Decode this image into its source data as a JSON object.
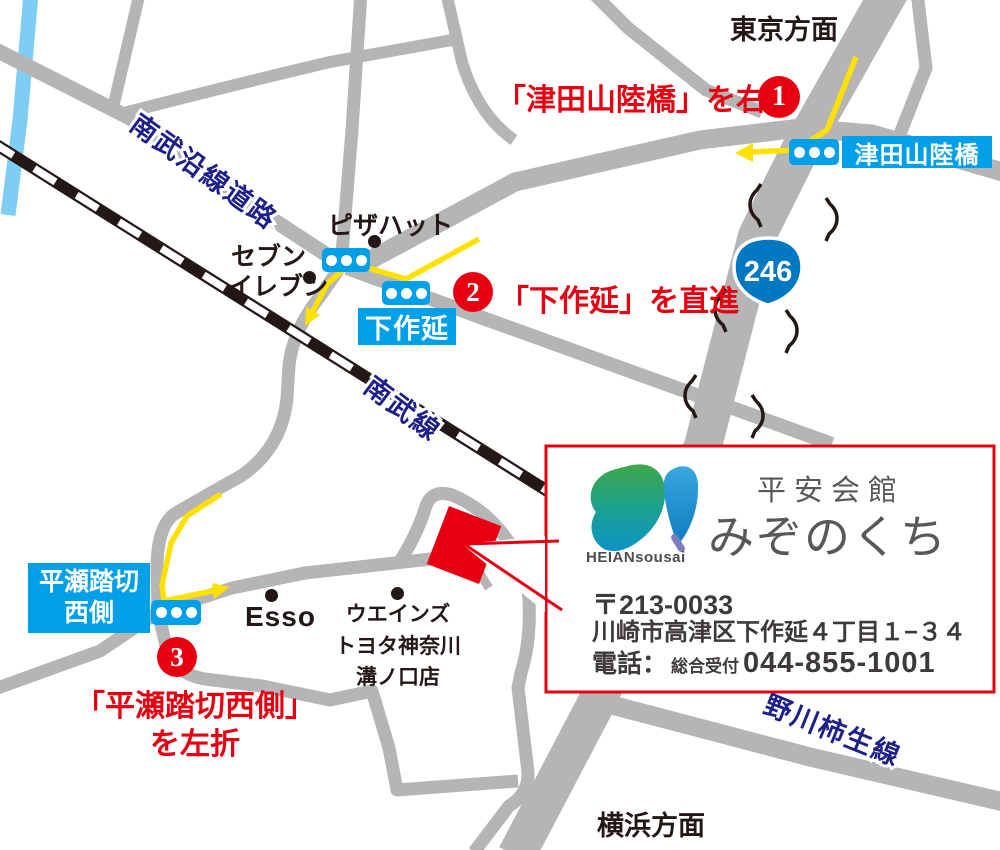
{
  "directions": {
    "tokyo": "東京方面",
    "yokohama": "横浜方面"
  },
  "roads": {
    "nanbu_ensen": "南武沿線道路",
    "nanbu_line": "南武線",
    "nogawa_kakio": "野川柿生線",
    "route_shield": "246"
  },
  "signals": {
    "tsudayama": "津田山陸橋",
    "shimosakunobe": "下作延",
    "hirase_line1": "平瀬踏切",
    "hirase_line2": "西側"
  },
  "steps": {
    "one": {
      "num": "1",
      "text": "「津田山陸橋」を右折"
    },
    "two": {
      "num": "2",
      "text": "「下作延」を直進"
    },
    "three": {
      "num": "3",
      "line1": "「平瀬踏切西側」",
      "line2": "を左折"
    }
  },
  "pois": {
    "pizza_hut": "ピザハット",
    "seven1": "セブン",
    "seven2": "イレブン",
    "esso": "Esso",
    "weins1": "ウエインズ",
    "weins2": "トヨタ神奈川",
    "weins3": "溝ノ口店"
  },
  "card": {
    "brand": "平安会館",
    "name": "みぞのくち",
    "logo": "HEIANsousai",
    "postal": "〒213-0033",
    "address": "川崎市高津区下作延４丁目１−３４",
    "tel_label": "電話：",
    "tel_sub": "総合受付",
    "tel": "044-855-1001"
  },
  "colors": {
    "road_gray": "#b5b5b6",
    "rail_black": "#231815",
    "river_blue": "#7ecef4",
    "signal_blue": "#00a0e9",
    "route_red": "#e60012",
    "route_yellow": "#ffe100",
    "roadname_navy": "#1d2088",
    "shield_blue": "#0079c2",
    "card_gray": "#595757"
  }
}
